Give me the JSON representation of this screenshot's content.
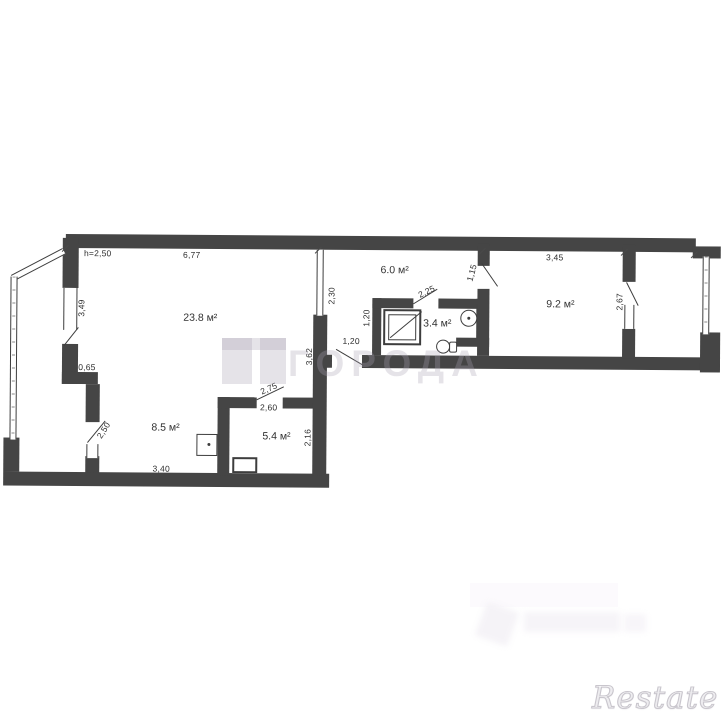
{
  "plan": {
    "ceiling_note": "h=2,50",
    "rooms": {
      "living": "23.8 м²",
      "kitchen": "8.5 м²",
      "small_room": "5.4 м²",
      "hallway": "6.0 м²",
      "bathroom": "3.4 м²",
      "bedroom": "9.2 м²"
    },
    "dims": {
      "top_living": "6,77",
      "left_window": "3,49",
      "left_step": "0,65",
      "kitchen_door": "2,50",
      "kitchen_width": "3,40",
      "small_room_door": "2,75",
      "small_room_width": "2,60",
      "small_room_height": "2,16",
      "inner_wall": "3,62",
      "hall_partition": "2,30",
      "bath_wall": "1,20",
      "hall_door": "1,20",
      "bath_door": "2,25",
      "bedroom_door": "1,15",
      "bedroom_width": "3,45",
      "balcony_door": "2,67"
    }
  },
  "watermarks": {
    "center": "ГОРОДА",
    "bottom_right": "Restate"
  },
  "colors": {
    "wall": "#454545",
    "line": "#3d3d3d",
    "dim_text": "#2e2e2e",
    "watermark": "#e7e4e9"
  }
}
